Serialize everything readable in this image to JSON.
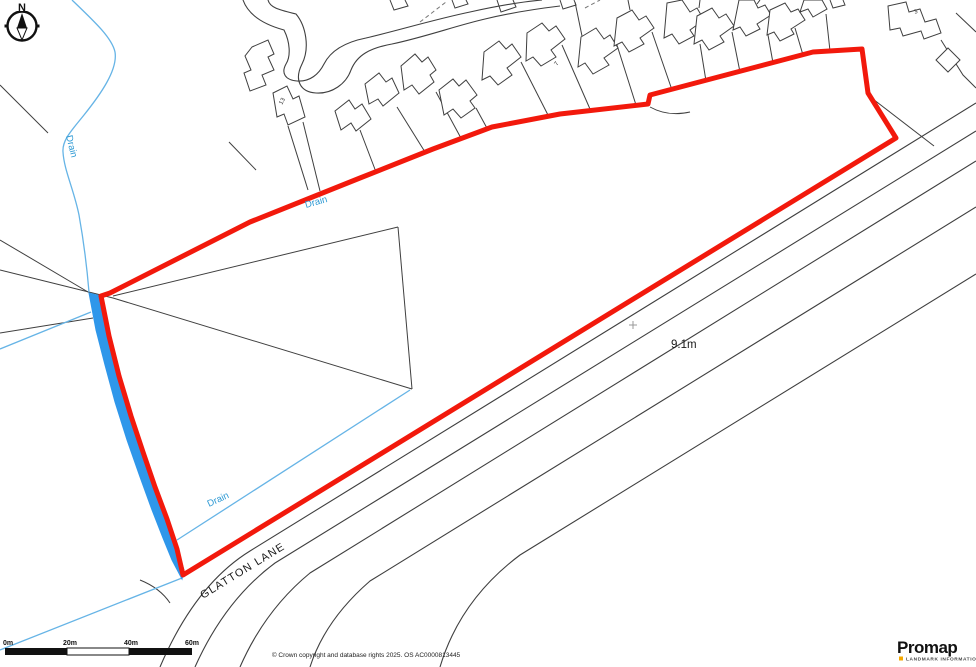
{
  "canvas": {
    "width": 976,
    "height": 667
  },
  "colors": {
    "site_boundary_red": "#f2190c",
    "water_fill_blue": "#2f97ea",
    "drain_line_blue": "#66b4e6",
    "drain_label_blue": "#2f9ad4",
    "map_line_grey": "#3f3f3f",
    "promap_accent_yellow": "#f5a800"
  },
  "compass": {
    "north_label": "N"
  },
  "map_labels": {
    "drain_west": "Drain",
    "drain_mid": "Drain",
    "drain_south": "Drain",
    "road_name": "GLATTON LANE",
    "spot_height": "9.1m",
    "house_number_13": "13",
    "house_number_7": "7",
    "house_number_3": "3"
  },
  "scale_bar": {
    "ticks": [
      "0m",
      "20m",
      "40m",
      "60m"
    ]
  },
  "footer": {
    "copyright": "© Crown copyright and database rights 2025. OS AC0000813445"
  },
  "branding": {
    "logo_text": "Promap",
    "tagline": "LANDMARK INFORMATION"
  }
}
